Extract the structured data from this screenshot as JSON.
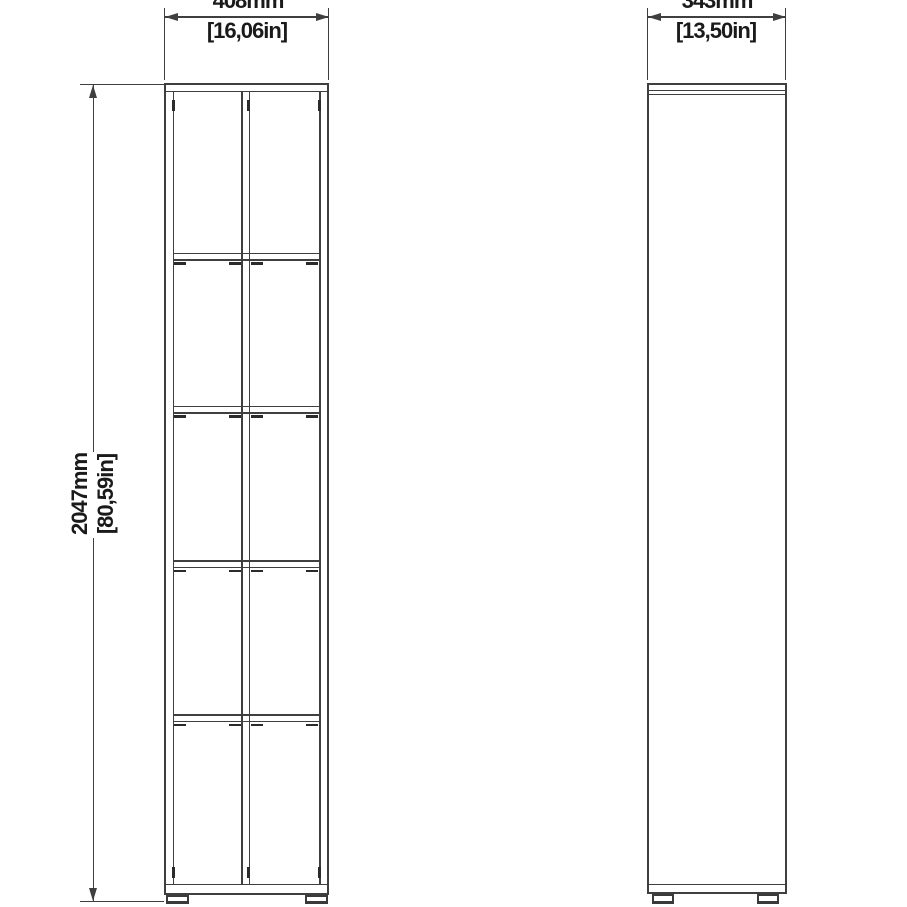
{
  "drawing": {
    "type": "furniture-dimension-diagram",
    "subject": "tall narrow bookcase, front and side orthographic views",
    "front_view": {
      "columns": 2,
      "shelves_per_column": 4,
      "feet": 2
    },
    "side_view": {
      "feet": 2
    },
    "style": {
      "line_color": "#3f3f3f",
      "text_color": "#1a1a1a",
      "background": "#ffffff"
    }
  },
  "dimensions": {
    "width": {
      "mm": "408mm",
      "inches": "[16,06in]"
    },
    "depth": {
      "mm": "343mm",
      "inches": "[13,50in]"
    },
    "height": {
      "mm": "2047mm",
      "inches": "[80,59in]"
    }
  }
}
